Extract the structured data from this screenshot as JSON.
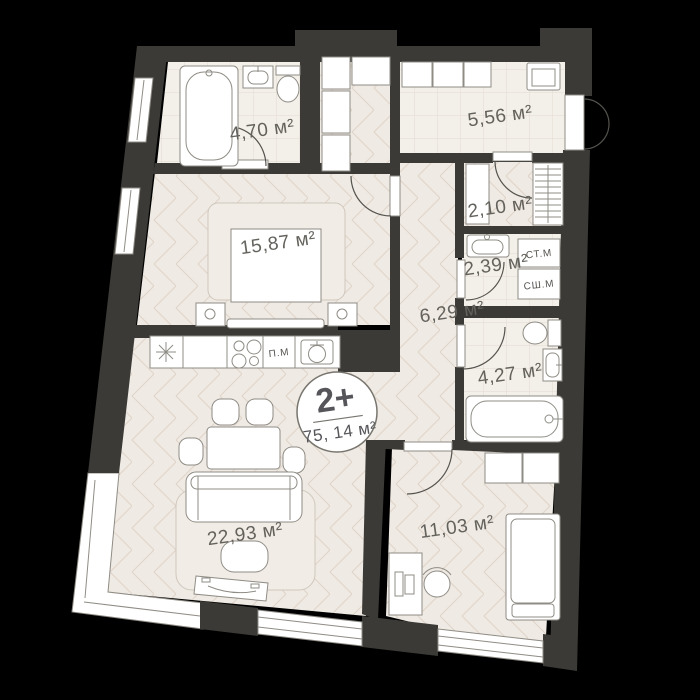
{
  "floorplan": {
    "badge": {
      "rooms_label": "2+",
      "total_area_label": "75, 14 м²"
    },
    "rooms": [
      {
        "name": "bathroom",
        "area_label": "4,70 м²"
      },
      {
        "name": "hallway",
        "area_label": "5,56 м²"
      },
      {
        "name": "closet",
        "area_label": "2,10 м²"
      },
      {
        "name": "laundry",
        "area_label": "2,39 м²"
      },
      {
        "name": "corridor",
        "area_label": "6,29 м²"
      },
      {
        "name": "bedroom",
        "area_label": "15,87 м²"
      },
      {
        "name": "wc",
        "area_label": "4,27 м²"
      },
      {
        "name": "living-kitchen",
        "area_label": "22,93 м²"
      },
      {
        "name": "bedroom-2",
        "area_label": "11,03 м²"
      }
    ],
    "appliances": {
      "washer": "СТ.М",
      "dryer": "СШ.М",
      "dishwasher": "П.М"
    },
    "colors": {
      "background": "#000000",
      "wall": "#3b3a36",
      "tile_floor": "#f3efe9",
      "wood_floor": "#efeae3",
      "furniture_outline": "#8f8c85",
      "label_text": "#64625c",
      "badge_text": "#55555a"
    }
  }
}
